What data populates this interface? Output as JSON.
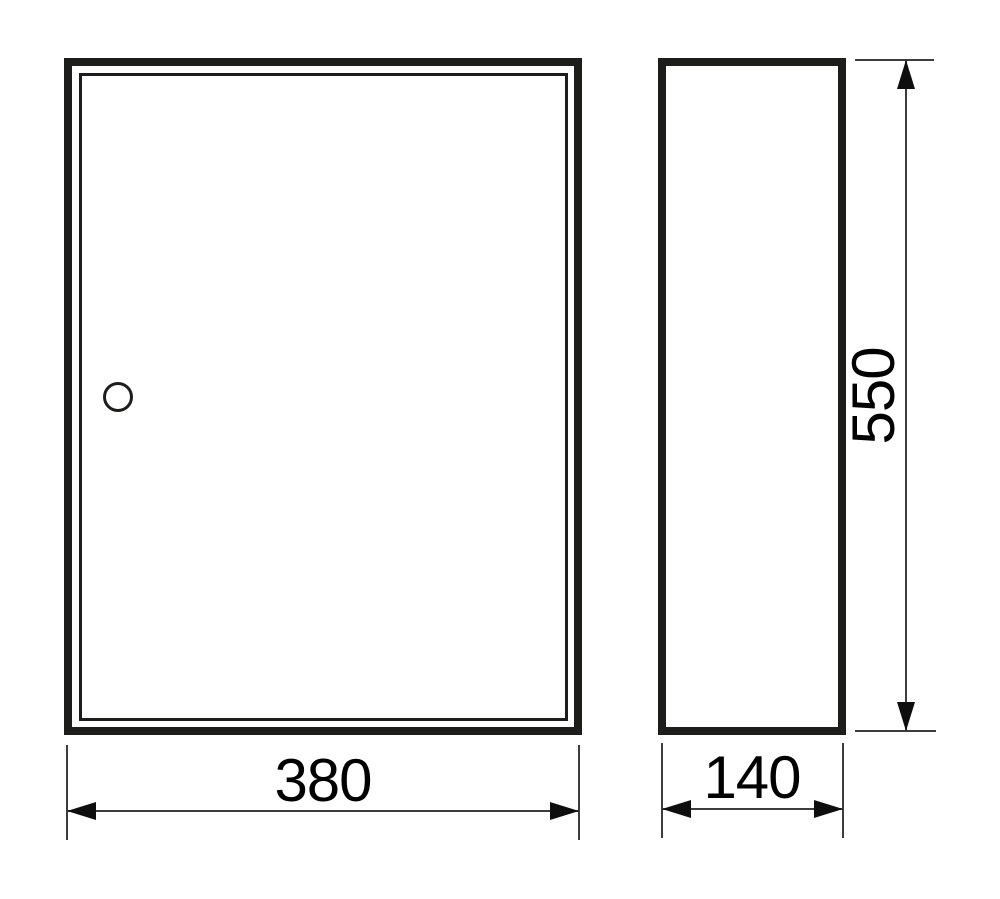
{
  "drawing": {
    "dimensions": {
      "width": "380",
      "depth": "140",
      "height": "550"
    },
    "colors": {
      "line": "#1d1d1b",
      "thin_line": "#3d3d3d",
      "text": "#000000",
      "background": "#ffffff"
    }
  }
}
